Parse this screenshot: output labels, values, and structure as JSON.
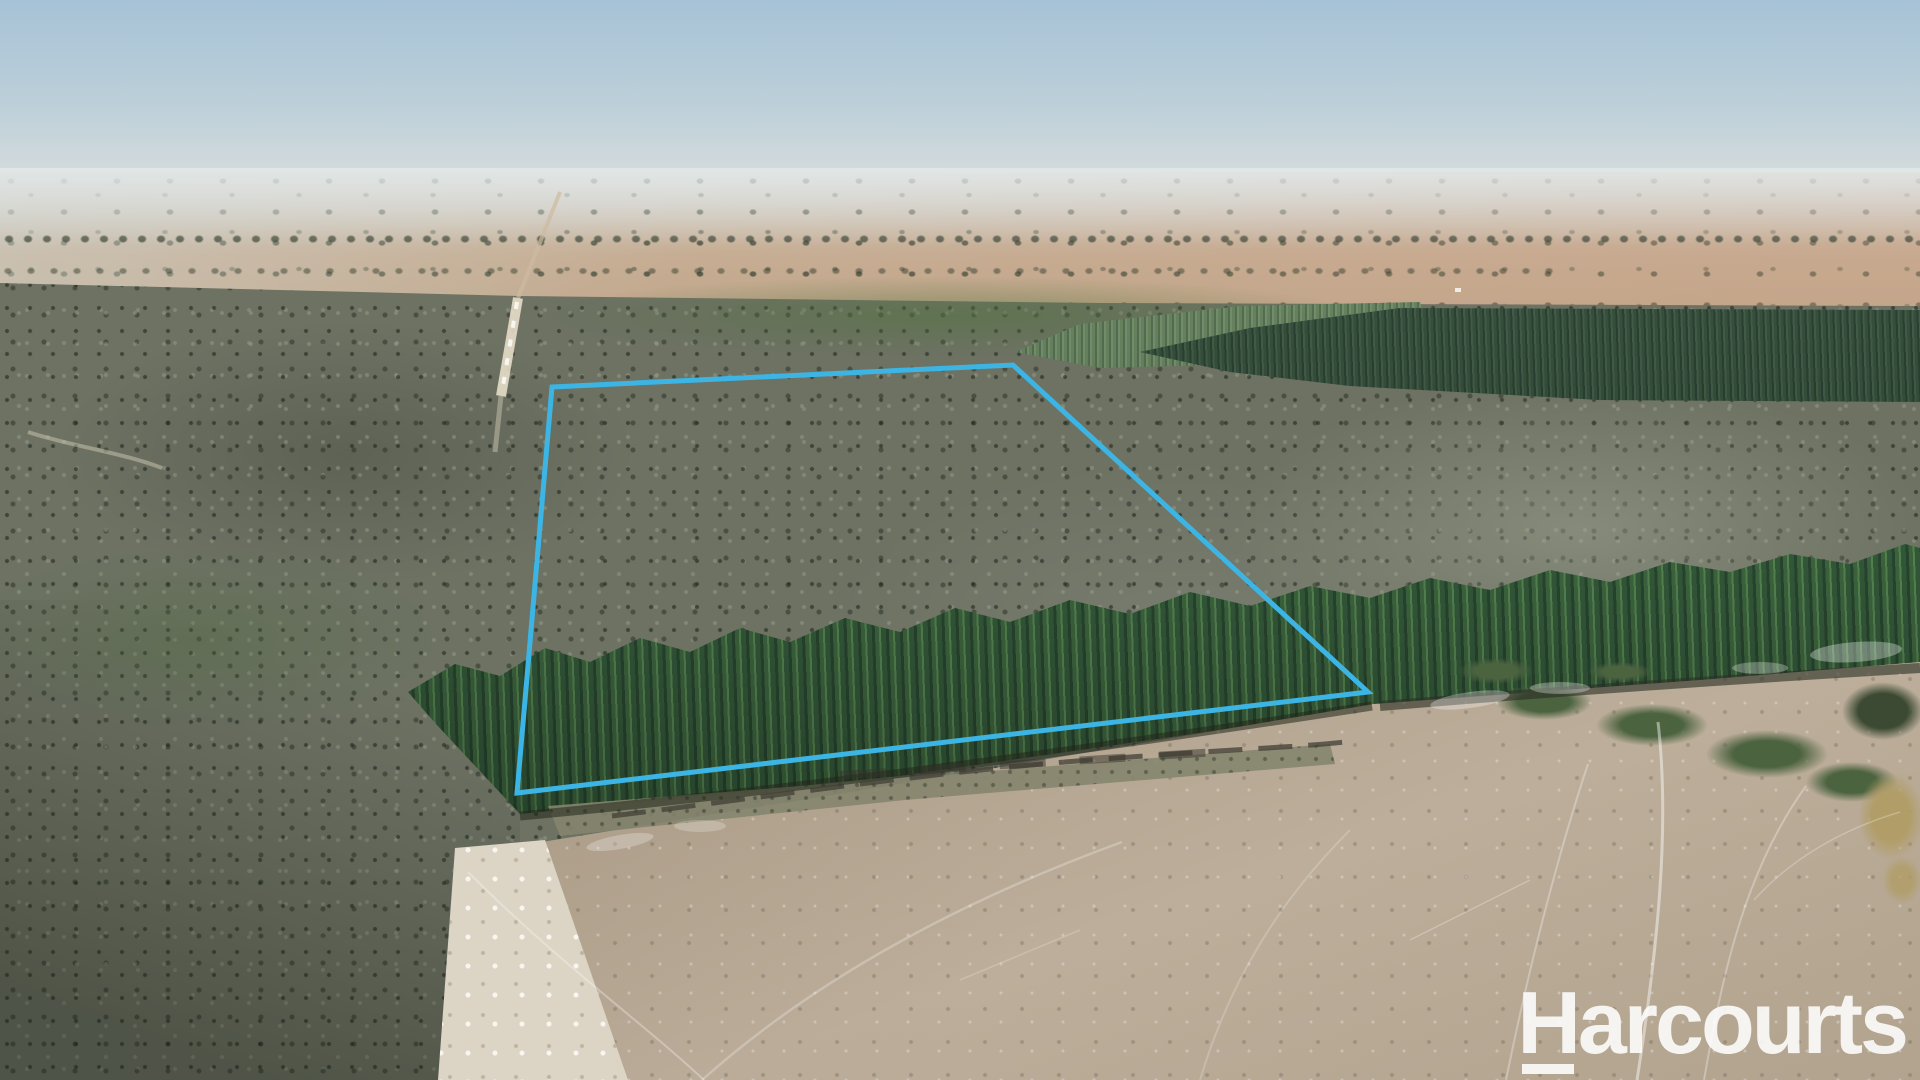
{
  "image": {
    "description": "Aerial drone photograph of a rural bushland property with a highlighted lot boundary, dry farmland on the horizon, a dark pine plantation band, a bright pine tree row and a cleared dry paddock in the foreground",
    "width": 1920,
    "height": 1080
  },
  "watermark": {
    "text": "Harcourts",
    "color": "#ffffff",
    "opacity": 0.88
  },
  "property_boundary": {
    "color": "#3db5e4",
    "stroke_width": 5,
    "points": [
      [
        552,
        387
      ],
      [
        1013,
        365
      ],
      [
        1368,
        692
      ],
      [
        517,
        793
      ]
    ]
  },
  "palette": {
    "sky_top": "#a6c2d6",
    "sky_horizon": "#d7dddd",
    "farmland": "#c6ad93",
    "forest": "#6d7263",
    "plantation_dark": "#2b4832",
    "plantation_light": "#55754a",
    "pine": "#3c6743",
    "pine_light": "#629a5c",
    "paddock": "#ab9a86",
    "paddock_light": "#bcae9a",
    "track_pale": "#dcd4c4",
    "scrub_grass": "#85856e",
    "shrub_green": "#4c6340",
    "marsh": "#3c4a33",
    "reeds": "#b19d67"
  }
}
